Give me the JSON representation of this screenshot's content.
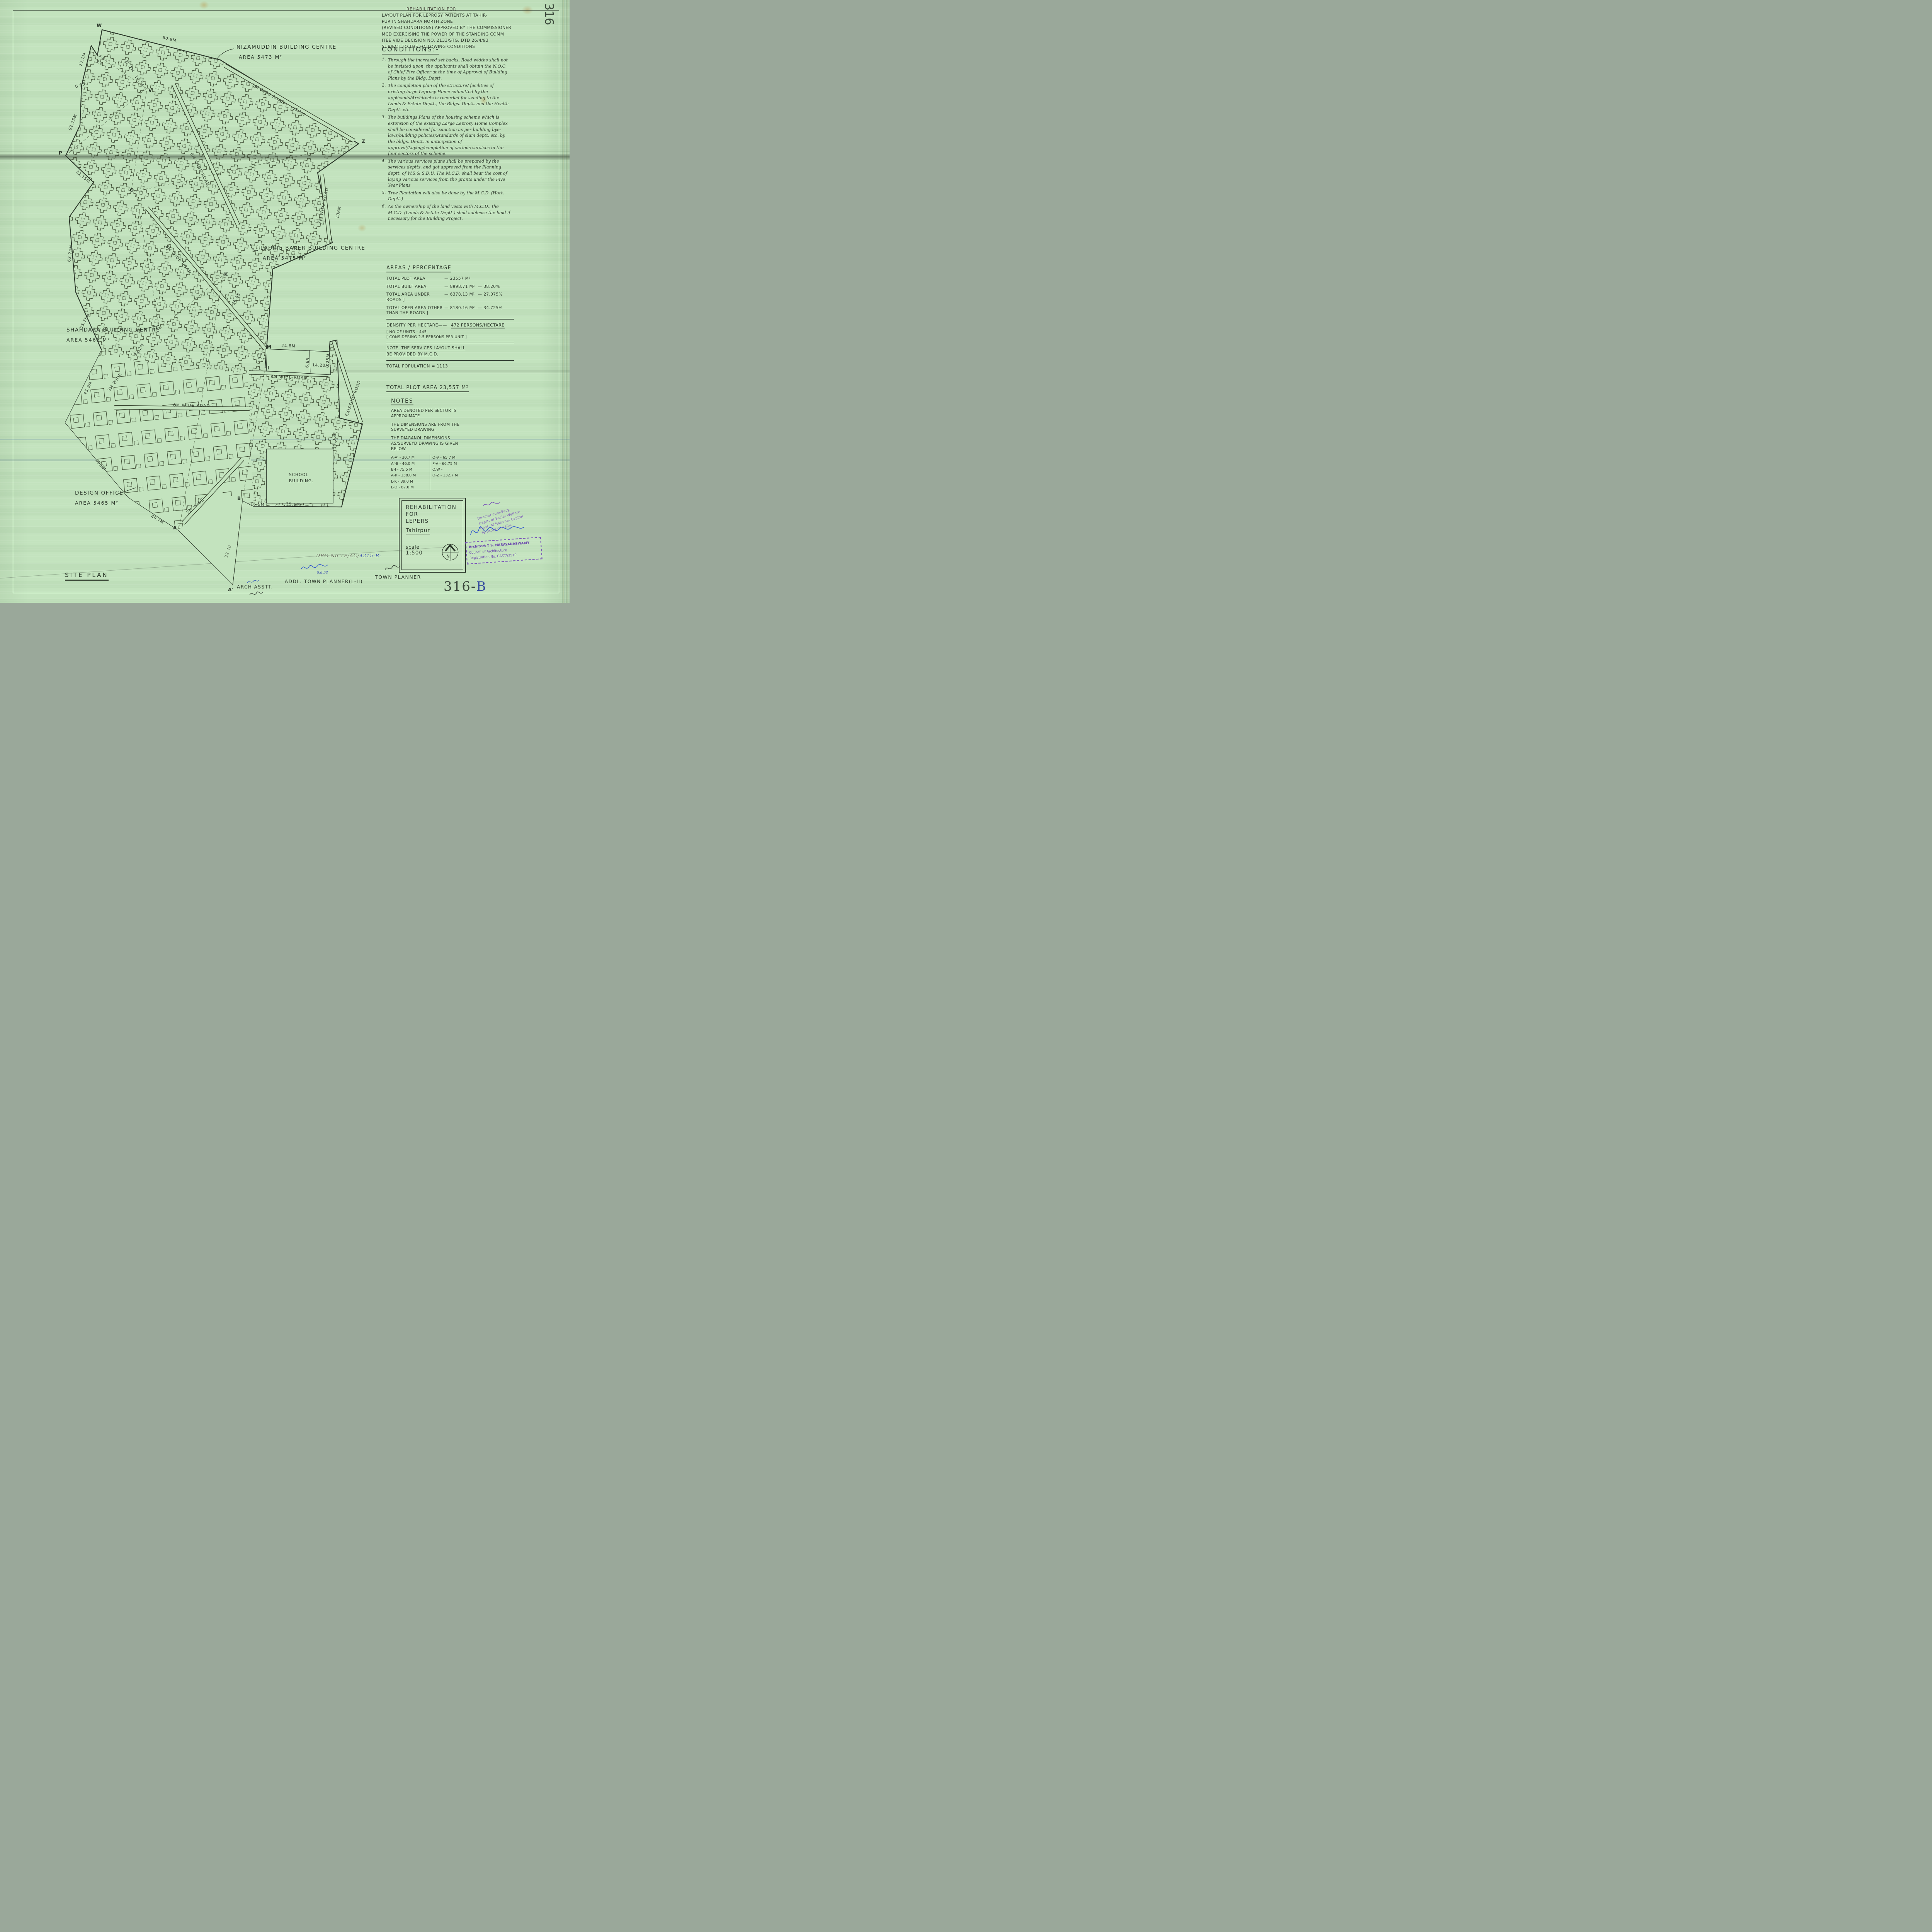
{
  "sheet": {
    "edge_number": "316",
    "corner_number": "316-",
    "corner_number_suffix": "B",
    "drg_prefix": "DRG No TP/AC/",
    "drg_value": "4215-B-"
  },
  "header": {
    "small_title": "REHABILITATION FOR",
    "intro_lines": [
      "LAYOUT PLAN FOR LEPROSY PATIENTS AT TAHIR-",
      "PUR IN SHAHDARA NORTH ZONE",
      "(REVISED CONDITIONS) APPROVED BY THE COMMISSIONER",
      "MCD EXERCISING THE POWER OF THE STANDING COMM",
      "ITEE VIDE DECISION NO. 2133/STG. DTD 26/4/93",
      "SUBJECT TO THE FOLLOWING CONDITIONS"
    ],
    "conditions_title": "CONDITIONS:-",
    "conditions": [
      {
        "num": "1.",
        "text": "Through the increased set backs, Road widths shall not be insisted upon, the applicants shall obtain the N.O.C. of Chief Fire Officer at the time of Approval of Building Plans by the Bldg. Deptt."
      },
      {
        "num": "2.",
        "text": "The completion plan of the structure/ facilities of existing large Leprosy Home submitted by the applicants/Architects is recorded for sending to the Lands & Estate Deptt., the Bldgs. Deptt. and the Health Deptt. etc."
      },
      {
        "num": "3.",
        "text": "The buildings Plans of the housing scheme which is extension of the existing Large Leprosy Home Complex shall be considered for sanction as per building bye-laws/building policies/Standards of slum deptt. etc. by the bldgs. Deptt. in anticipation of approval/Laying/completion of various services in the four sectors of the scheme."
      },
      {
        "num": "4.",
        "text": "The various services plans shall be prepared by the services deptts. and got approved from the Planning deptt. of W.S.& S.D.U. The M.C.D. shall bear the cost of laying various services from the grants under the Five Year Plans"
      },
      {
        "num": "5.",
        "text": "Tree Plantation will also be done by the M.C.D. (Hort. Deptt.)"
      },
      {
        "num": "6.",
        "text": "As the ownership of the land vests with M.C.D., the M.C.D. (Lands & Estate Deptt.) shall sublease the land if necessary for the Building Project."
      }
    ]
  },
  "areas": {
    "title": "AREAS / PERCENTAGE",
    "rows": [
      {
        "label": "TOTAL PLOT AREA",
        "value": "23557 M²",
        "pct": ""
      },
      {
        "label": "TOTAL BUILT AREA",
        "value": "8998.71 M²",
        "pct": "38.20%"
      },
      {
        "label": "TOTAL AREA UNDER ROADS ]",
        "value": "6378.13 M²",
        "pct": "27.075%"
      },
      {
        "label": "TOTAL OPEN AREA OTHER THAN THE ROADS ]",
        "value": "8180.16 M²",
        "pct": "34.725%"
      }
    ],
    "density_label": "DENSITY PER HECTARE",
    "density_value": "472 PERSONS/HECTARE",
    "units_line1": "[ NO OF UNITS - 445",
    "units_line2": "[ CONSIDERING 2.5 PERSONS PER UNIT ]",
    "note_line1": "NOTE: THE SERVICES LAYOUT SHALL",
    "note_line2": "BE PROVIDED BY M.C.D.",
    "population": "TOTAL POPULATION = 1113",
    "total_plot": "TOTAL PLOT AREA 23,557 M²"
  },
  "notes": {
    "title": "NOTES",
    "paras": [
      "AREA DENOTED PER SECTOR IS APPROXIMATE",
      "THE DIMENSIONS ARE FROM THE SURVEYED DRAWING.",
      "THE DIAGANOL DIMENSIONS AS/SURVEYD DRAWING IS GIVEN BELOW"
    ],
    "diag_left": [
      "A-A' - 30.7 M",
      "A'-B - 46.0 M",
      "B-I - 75.5 M",
      "A-K - 138.0 M",
      "L-K - 39.0 M",
      "L-O - 87.0 M"
    ],
    "diag_right": [
      "O-V - 65.7 M",
      "P-V - 66.75 M",
      "O.W -",
      "O-Z - 132.7 M"
    ]
  },
  "title_block": {
    "line1": "REHABILITATION",
    "line2": "FOR",
    "line3": "LEPERS",
    "subtitle": "Tahirpur",
    "scale_label": "scale",
    "scale_value": "1:500",
    "north": "N"
  },
  "stamps": {
    "architect_line1": "Architect T S. NARAYANASWAMY",
    "architect_line2": "Council of Architecture",
    "architect_line3": "Registration No.  CA/77/3519",
    "director_line1": "Director-cum-Secy.",
    "director_line2": "Deptt. of Social Welfare",
    "director_line3": "Govt. of National Capital",
    "director_line4": "Territory of Delhi."
  },
  "footer": {
    "site_plan": "SITE PLAN",
    "arch": "ARCH ASSTT.",
    "addl": "ADDL. TOWN PLANNER(L-II)",
    "town": "TOWN PLANNER",
    "sig_date": "5.6.93"
  },
  "plan": {
    "sectors": [
      {
        "name": "NIZAMUDDIN BUILDING CENTRE",
        "area": "AREA 5473 M²"
      },
      {
        "name": "LAURIE BAKER BUILDING CENTRE",
        "area": "AREA 5475 M²"
      },
      {
        "name": "SHAHDARA BUILDING CENTRE",
        "area": "AREA 5466 M²"
      },
      {
        "name": "DESIGN OFFICE",
        "area": "AREA 5465 M²"
      }
    ],
    "school_line1": "SCHOOL",
    "school_line2": "BUILDING.",
    "roads": [
      "3M WIDE ROAD",
      "6M WIDE ROAD",
      "3M WIDE ROAD",
      "8M WIDE ROAD",
      "6M WIDE ROAD",
      "8M WIDE ROAD",
      "EXISTING ROAD",
      "3M WIDE",
      "3M WIDE"
    ],
    "dims": [
      "60.9M.",
      "22.1M",
      "10.75",
      "27.2M",
      "0.65",
      "5.2",
      "2.9",
      "92.25M",
      "31.15M",
      "55.5M",
      "108M",
      "63.75M",
      "55.75M",
      "36.55",
      "32.2M",
      "13.2",
      "24.8M",
      "6.65",
      "14.20M",
      "8.25M",
      "59.35M",
      "35.1M",
      "16.5M",
      "45.9M",
      "85.5M",
      "40.7M",
      "32.70"
    ],
    "vertices": [
      "W",
      "V",
      "Z",
      "P",
      "O",
      "K",
      "L",
      "M",
      "I",
      "B",
      "A",
      "A'"
    ]
  }
}
